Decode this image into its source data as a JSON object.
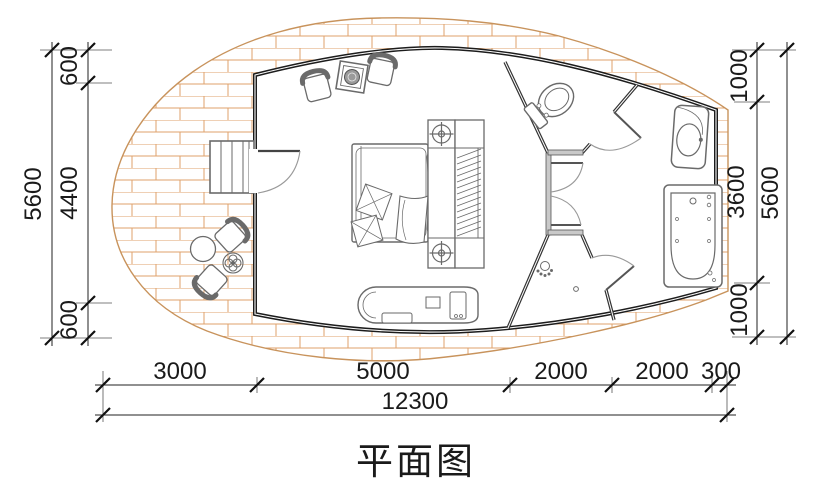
{
  "title": "平面图",
  "dimensions": {
    "left": {
      "overall": "5600",
      "segments": [
        "600",
        "4400",
        "600"
      ]
    },
    "right": {
      "overall": "5600",
      "segments": [
        "1000",
        "3600",
        "1000"
      ]
    },
    "bottom": {
      "overall": "12300",
      "segments": [
        "3000",
        "5000",
        "2000",
        "2000",
        "300"
      ]
    }
  },
  "colors": {
    "wall": "#1c1c1c",
    "deck_brick": "#dfa26b",
    "deck_edge": "#c8935c",
    "fixture_line": "#6a6a6a",
    "dimension": "#1a1a1a",
    "background": "#ffffff"
  },
  "fixtures": [
    "stairs",
    "entrance-door",
    "fireplace-stove",
    "armchair",
    "bed",
    "headboard-nightstand",
    "table-lamp",
    "wardrobe",
    "lounge-tub",
    "deck-chair",
    "round-table",
    "side-table",
    "toilet",
    "interior-door",
    "shower-spray",
    "floor-drain",
    "sink-vanity",
    "bathtub"
  ]
}
